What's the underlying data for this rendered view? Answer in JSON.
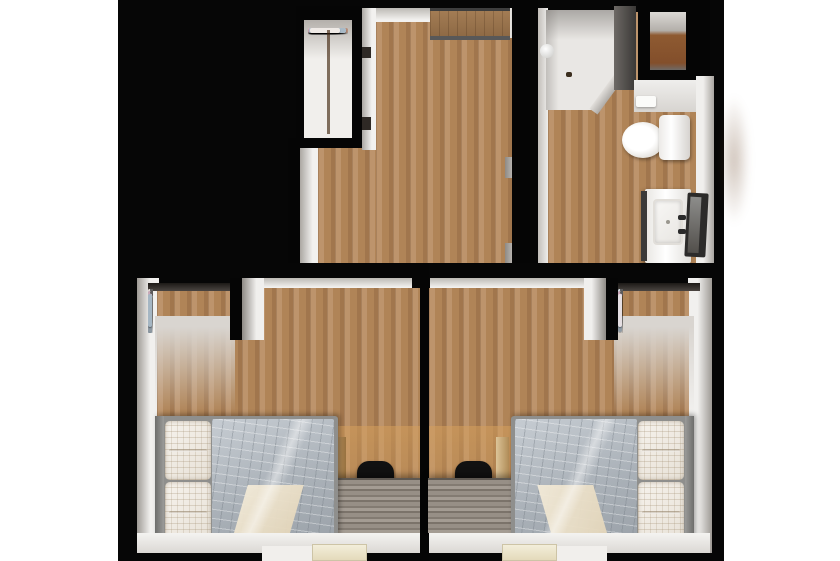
{
  "scene": {
    "title": "Top-down 3D floor plan render",
    "type": "floorplan-render",
    "rooms": [
      {
        "name": "walk-in-closet",
        "label": "Walk-in closet",
        "furniture": [
          "hanging-clothes-rail"
        ]
      },
      {
        "name": "top-room",
        "label": "Room with wood floor",
        "furniture": [
          "sliding-door-recess"
        ]
      },
      {
        "name": "bathroom",
        "label": "Bathroom",
        "furniture": [
          "shower",
          "storage-niche",
          "toilet",
          "sink-vanity",
          "open-door",
          "bath-mat"
        ]
      },
      {
        "name": "bedroom-left",
        "label": "Bedroom (left)",
        "furniture": [
          "single-bed",
          "pillows",
          "gray-quilt",
          "cream-throw",
          "desk",
          "office-chair",
          "clothes-rail",
          "door"
        ]
      },
      {
        "name": "bedroom-right",
        "label": "Bedroom (right)",
        "furniture": [
          "single-bed",
          "pillows",
          "gray-quilt",
          "cream-throw",
          "desk",
          "office-chair",
          "clothes-rail",
          "door"
        ]
      }
    ]
  },
  "palette": {
    "canvas": "#ffffff",
    "backdrop": "#060606",
    "wood": "#b08457",
    "woodLight": "#bd946c",
    "woodDark": "#a1764d",
    "showerFloor": "#e9e7e4",
    "nicheFloor": "#8e5a31",
    "recessWood": "#a37c54",
    "blanketLight": "#c6ccd2",
    "blanketDark": "#9aa1a8",
    "pillow": "#f6f2ec",
    "throwCream": "#f2ead8",
    "deskLight": "#a49c93",
    "deskDark": "#837b72",
    "chair": "#111111",
    "doorCream": "#f3eeda",
    "darkDoor": "#2c2b2a"
  },
  "clothes": {
    "closet_top": [
      "#e8e3df",
      "#cfd8de",
      "#c2a9b8",
      "#e3d5d0",
      "#9fb3c2",
      "#d8cfd6",
      "#b98f7a",
      "#e6e0da",
      "#c87f96",
      "#d5a9bb",
      "#cbd5dc",
      "#e9e4e0",
      "#a9bac7",
      "#d9ccc4",
      "#b7c6d0",
      "#efeae6"
    ],
    "bedroom_left": [
      "#e5dfe3",
      "#c9a4b6",
      "#aebfcc",
      "#8f9aa4",
      "#e8e2dc",
      "#b9899c",
      "#d3dbe1",
      "#c4aebd",
      "#97a5b1",
      "#e2d8d3",
      "#c795aa",
      "#b3c2cd",
      "#8d98a2",
      "#e7e1db",
      "#cbaab9",
      "#a5b6c3"
    ],
    "bedroom_right": [
      "#a5b6c3",
      "#cbaab9",
      "#e7e1db",
      "#8d98a2",
      "#b3c2cd",
      "#c795aa",
      "#e2d8d3",
      "#97a5b1",
      "#c4aebd",
      "#d3dbe1",
      "#b9899c",
      "#e8e2dc",
      "#8f9aa4",
      "#aebfcc",
      "#c9a4b6",
      "#e5dfe3"
    ]
  }
}
